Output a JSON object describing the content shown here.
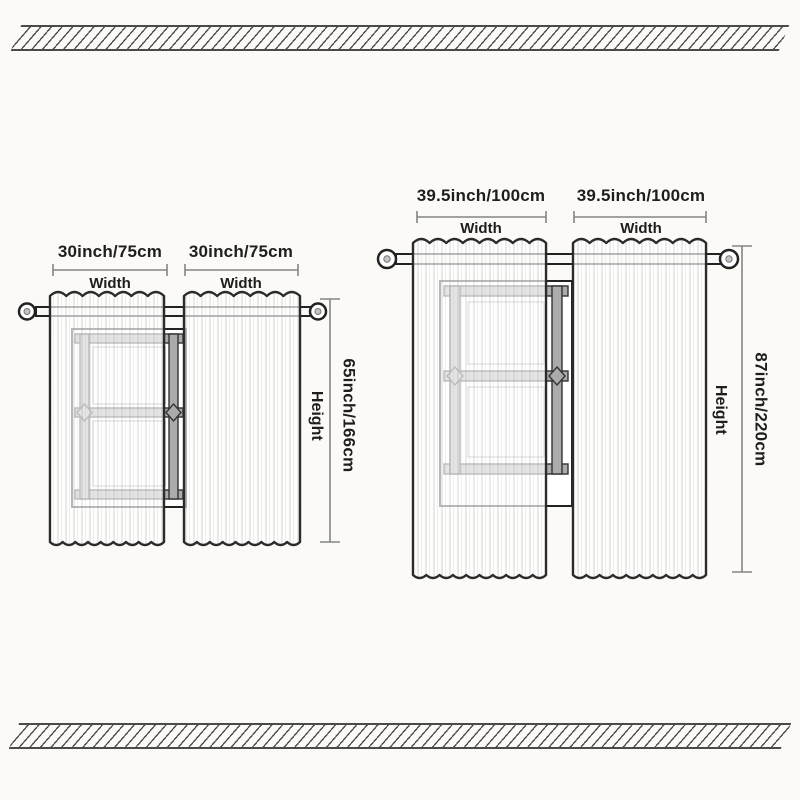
{
  "diagrams": {
    "small": {
      "panel1_width": "30inch/75cm",
      "panel2_width": "30inch/75cm",
      "width_caption": "Width",
      "height_value": "65inch/166cm",
      "height_caption": "Height"
    },
    "large": {
      "panel1_width": "39.5inch/100cm",
      "panel2_width": "39.5inch/100cm",
      "width_caption": "Width",
      "height_value": "87inch/220cm",
      "height_caption": "Height"
    }
  },
  "colors": {
    "background": "#fbfaf7",
    "outline": "#2b2b2b",
    "window_frame_gray": "#ababab",
    "dimension_line": "#858585",
    "hatch_stripe": "#4a4a4a",
    "text": "#1e1e1e"
  }
}
